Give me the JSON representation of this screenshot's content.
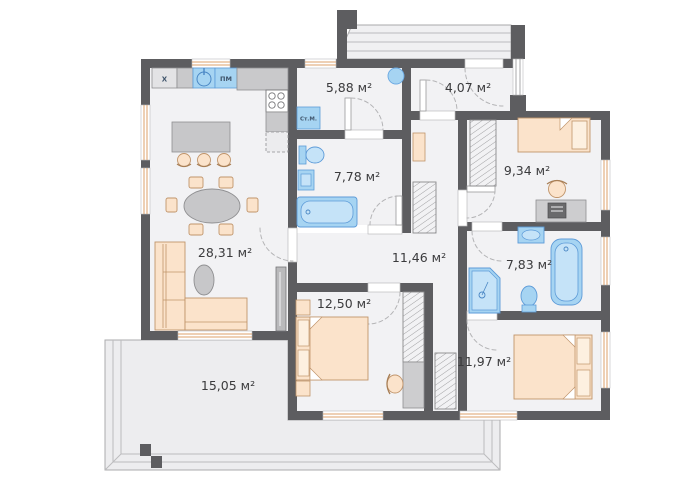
{
  "plan": {
    "unit_suffix": "м²",
    "rooms": [
      {
        "id": "living-kitchen",
        "area_label": "28,31 м²"
      },
      {
        "id": "utility-room",
        "area_label": "5,88 м²"
      },
      {
        "id": "entry-hall",
        "area_label": "4,07 м²"
      },
      {
        "id": "bathroom-main",
        "area_label": "7,78 м²"
      },
      {
        "id": "bedroom-small",
        "area_label": "9,34 м²"
      },
      {
        "id": "corridor",
        "area_label": "11,46 м²"
      },
      {
        "id": "bathroom-second",
        "area_label": "7,83 м²"
      },
      {
        "id": "bedroom-master",
        "area_label": "12,50 м²"
      },
      {
        "id": "bedroom-third",
        "area_label": "11,97 м²"
      },
      {
        "id": "terrace",
        "area_label": "15,05 м²"
      }
    ],
    "appliance_labels": {
      "fridge": "Х",
      "dishwasher": "ПМ",
      "washing_machine": "Ст.М."
    },
    "colors": {
      "wall": "#5d5d60",
      "floor": "#f2f2f4",
      "terrace_floor": "#ededef",
      "furniture_peach": "#fbe3cb",
      "furniture_peach_stroke": "#c0946a",
      "furniture_gray": "#c9c9cb",
      "fixture_blue": "#a6d4f2",
      "fixture_blue_stroke": "#5d9bd8",
      "window_sill": "#dca06b",
      "door_arc": "#b4b4b6",
      "text": "#3b3b3d"
    }
  }
}
